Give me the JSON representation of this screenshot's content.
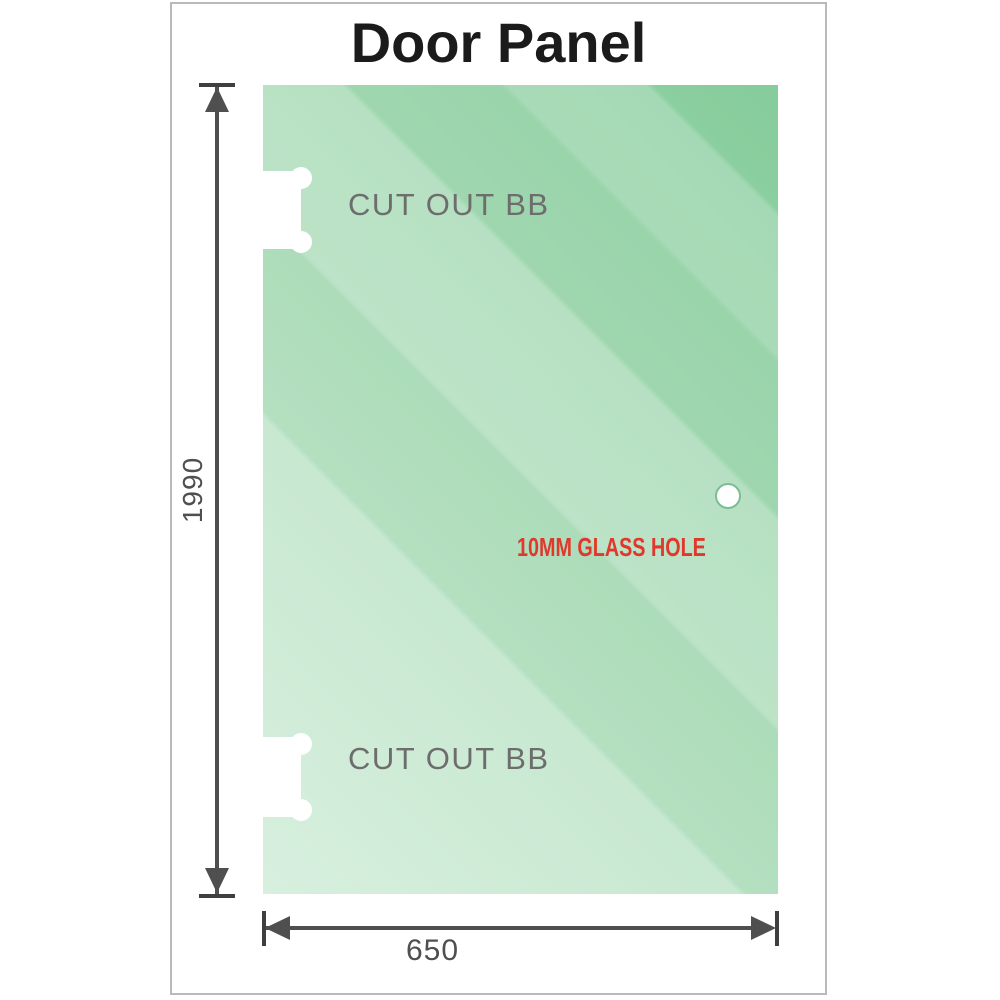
{
  "title": "Door Panel",
  "panel": {
    "cutouts": [
      {
        "label": "CUT OUT BB"
      },
      {
        "label": "CUT OUT BB"
      }
    ],
    "hole": {
      "label": "10MM GLASS HOLE"
    }
  },
  "dimensions": {
    "height": "1990",
    "width": "650"
  },
  "icons": {
    "arrow_up": "up-arrowhead",
    "arrow_down": "down-arrowhead",
    "arrow_left": "left-arrowhead",
    "arrow_right": "right-arrowhead"
  },
  "colors": {
    "glass_dark": "#86cc9c",
    "glass_base": "#9ed6ad",
    "glass_light": "#c3e8ce",
    "dim": "#4f4f4f",
    "tick": "#3f3f3f",
    "cutout_text": "#6d6d6d",
    "hole_text": "#e0382c",
    "hole_ring": "#7cbd93",
    "title_text": "#1b1b1b",
    "frame_border": "#b9b9b9"
  }
}
